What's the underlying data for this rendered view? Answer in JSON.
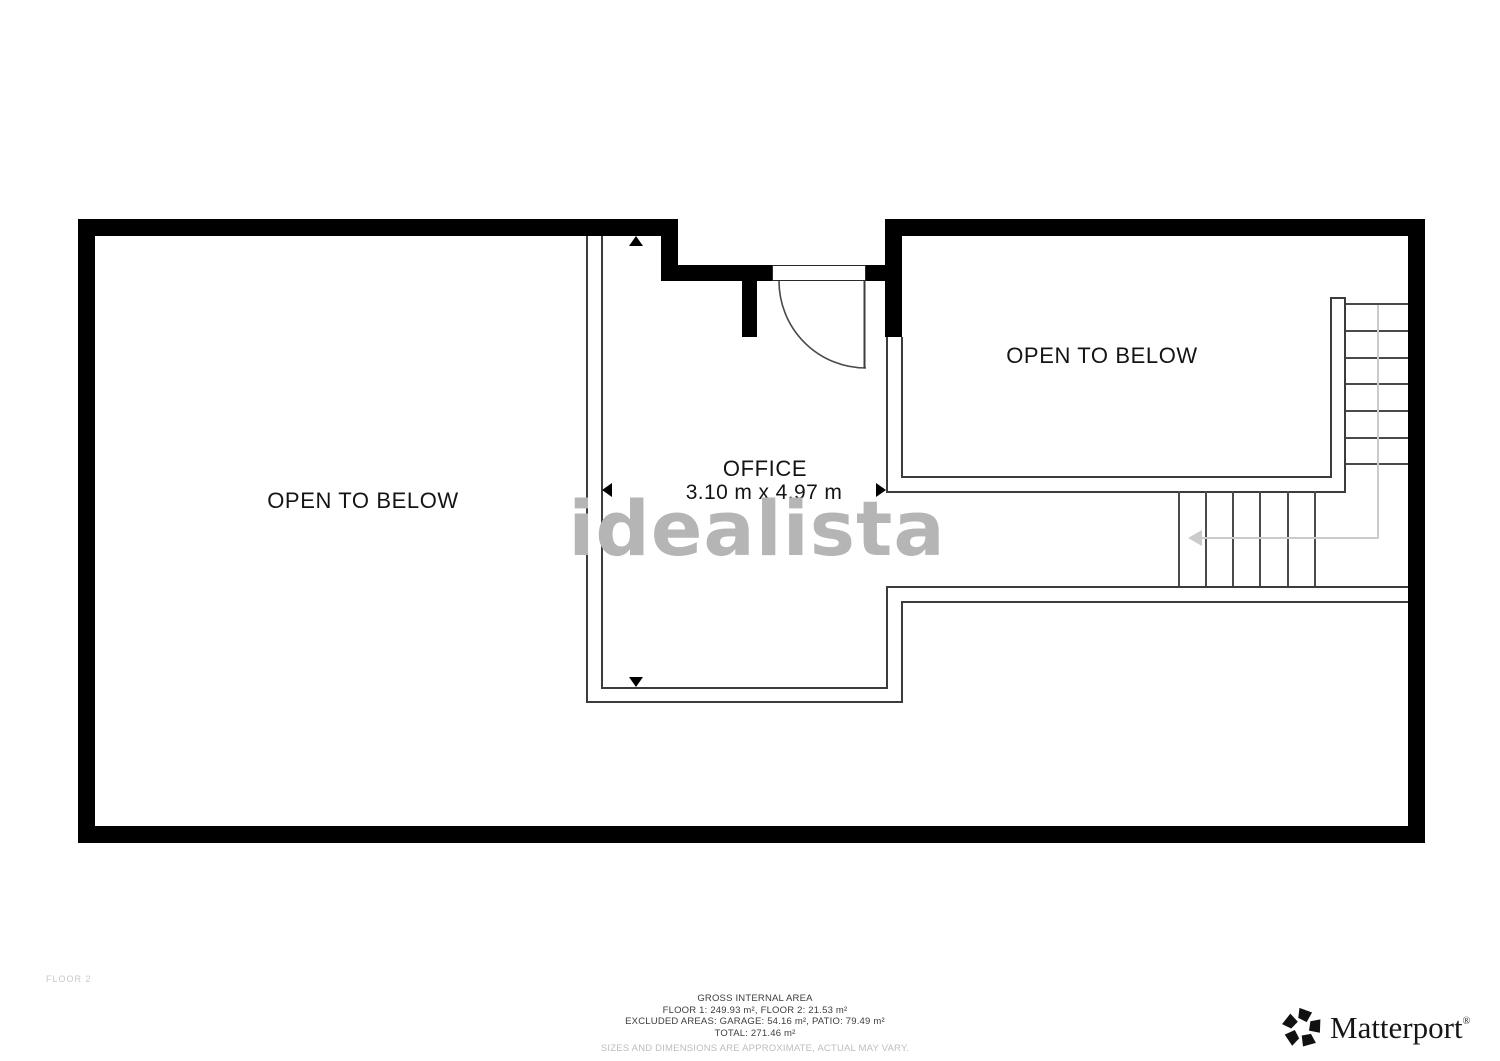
{
  "plan": {
    "floor_label": "FLOOR 2",
    "rooms": {
      "open_below_left": "OPEN TO BELOW",
      "open_below_right": "OPEN TO BELOW",
      "office": {
        "name": "OFFICE",
        "dimensions": "3.10 m x 4.97 m"
      }
    }
  },
  "watermark": {
    "text": "idealista"
  },
  "footer": {
    "area_summary": {
      "title": "GROSS INTERNAL AREA",
      "floors": "FLOOR 1: 249.93 m², FLOOR 2: 21.53 m²",
      "excluded": "EXCLUDED AREAS: GARAGE: 54.16 m², PATIO: 79.49 m²",
      "total": "TOTAL: 271.46 m²",
      "disclaimer": "SIZES AND DIMENSIONS ARE APPROXIMATE, ACTUAL MAY VARY."
    },
    "brand": {
      "name": "Matterport",
      "registered": "®"
    }
  },
  "colors": {
    "wall": "#000000",
    "thin_line": "#3c3c3c",
    "stair_walk_line": "#cbcbcb",
    "watermark_gray": "#b5b5b5",
    "label_text": "#141414",
    "footer_muted": "#bdbdbd"
  }
}
